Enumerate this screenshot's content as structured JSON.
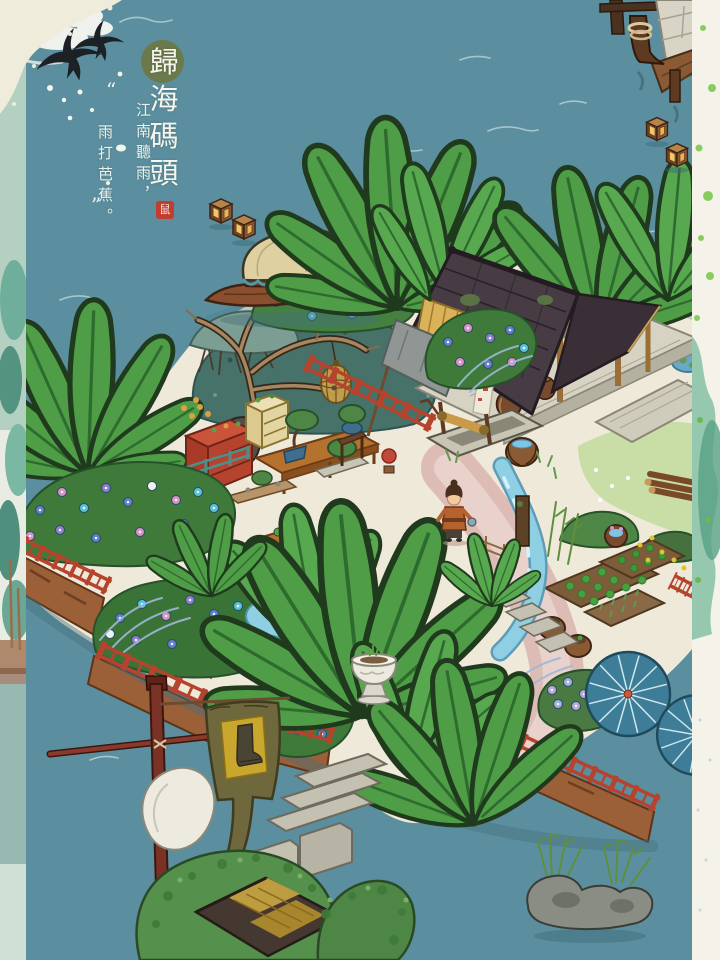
{
  "title": {
    "text": "歸海碼頭",
    "chars": [
      "歸",
      "海",
      "碼",
      "頭"
    ]
  },
  "poem": {
    "open_quote": "“",
    "line1": "江南聽雨，",
    "line2": "雨打芭蕉。",
    "close_quote": "”"
  },
  "seal": {
    "char": "鼠"
  },
  "colors": {
    "water": "#5b8f9f",
    "paper_border": "#f4f2e9",
    "corner_paper": "#f0ecdc",
    "title_circle": "#6b7a4b",
    "seal_red": "#c23c30",
    "banana_leaf": "#4f9d47",
    "roof_dark": "#473b44",
    "fence_red": "#b5432e",
    "sand_path": "#efe9da",
    "pink_path": "#dcbcb4",
    "stream_blue": "#8ecfe4",
    "umbrella_blue": "#3e7d98",
    "banner_olive": "#6e683c",
    "banner_yellow": "#c9a62e",
    "lantern_glow": "#f2c766",
    "cliff_brown": "#9c6038"
  },
  "scene": {
    "elements": [
      "swallow-icon",
      "cloud",
      "water-ripple",
      "floating-lantern",
      "mooring-post",
      "stone-wall",
      "wooden-walkway",
      "canopy-boat",
      "withered-tree",
      "bird-cage",
      "dock-pavilion",
      "storage-jar",
      "bamboo-blind",
      "canvas-awning",
      "shop-banner",
      "bonsai-stall",
      "display-shelf",
      "scholar-rock",
      "stone-well",
      "water-bucket",
      "villager",
      "banana-tree",
      "morning-glory-bed",
      "blue-fern",
      "vegetable-plot",
      "planter-barrel",
      "red-railing",
      "stream",
      "stepping-stones",
      "pond-driftwood",
      "stone-vase",
      "paper-umbrella",
      "flag-banner",
      "flag-pole",
      "stone-steps",
      "white-rock",
      "tree-canopy",
      "thatched-roof",
      "reed-islet",
      "watercolor-border",
      "title-seal"
    ]
  }
}
